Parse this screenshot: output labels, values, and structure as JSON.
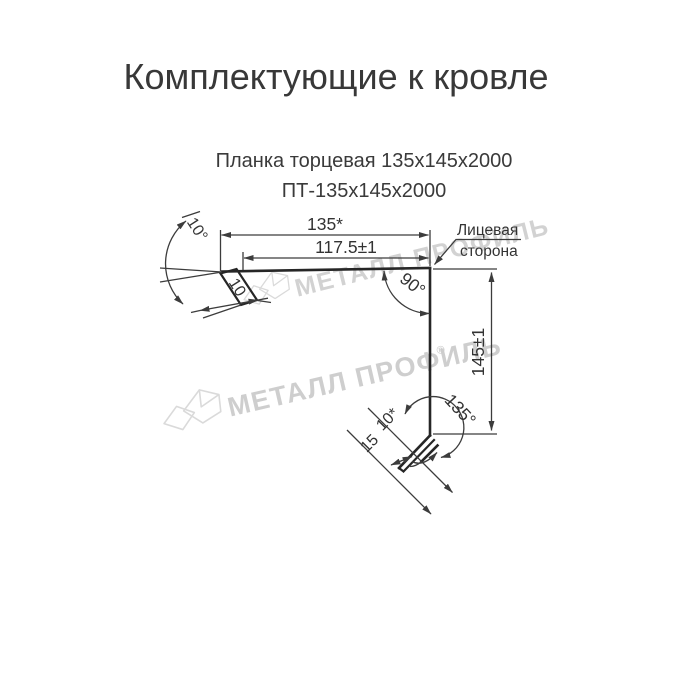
{
  "title": "Комплектующие к кровле",
  "product": {
    "name": "Планка торцевая 135х145х2000",
    "code": "ПТ-135х145х2000"
  },
  "drawing": {
    "dims": {
      "top_width": "135*",
      "top_width_inner": "117.5±1",
      "right_angle": "90°",
      "side_height": "145±1",
      "bottom_angle": "135°",
      "left_angle": "10°",
      "left_flange": "10",
      "hem": "10*",
      "bottom_flange": "15"
    },
    "labels": {
      "face_side_line1": "Лицевая",
      "face_side_line2": "сторона"
    }
  },
  "watermark": {
    "text": "МЕТАЛЛ ПРОФИЛЬ",
    "symbol": "®",
    "color": "#cbcbcb"
  },
  "colors": {
    "background": "#ffffff",
    "text": "#3a3a3a",
    "line": "#2e2e2e"
  }
}
